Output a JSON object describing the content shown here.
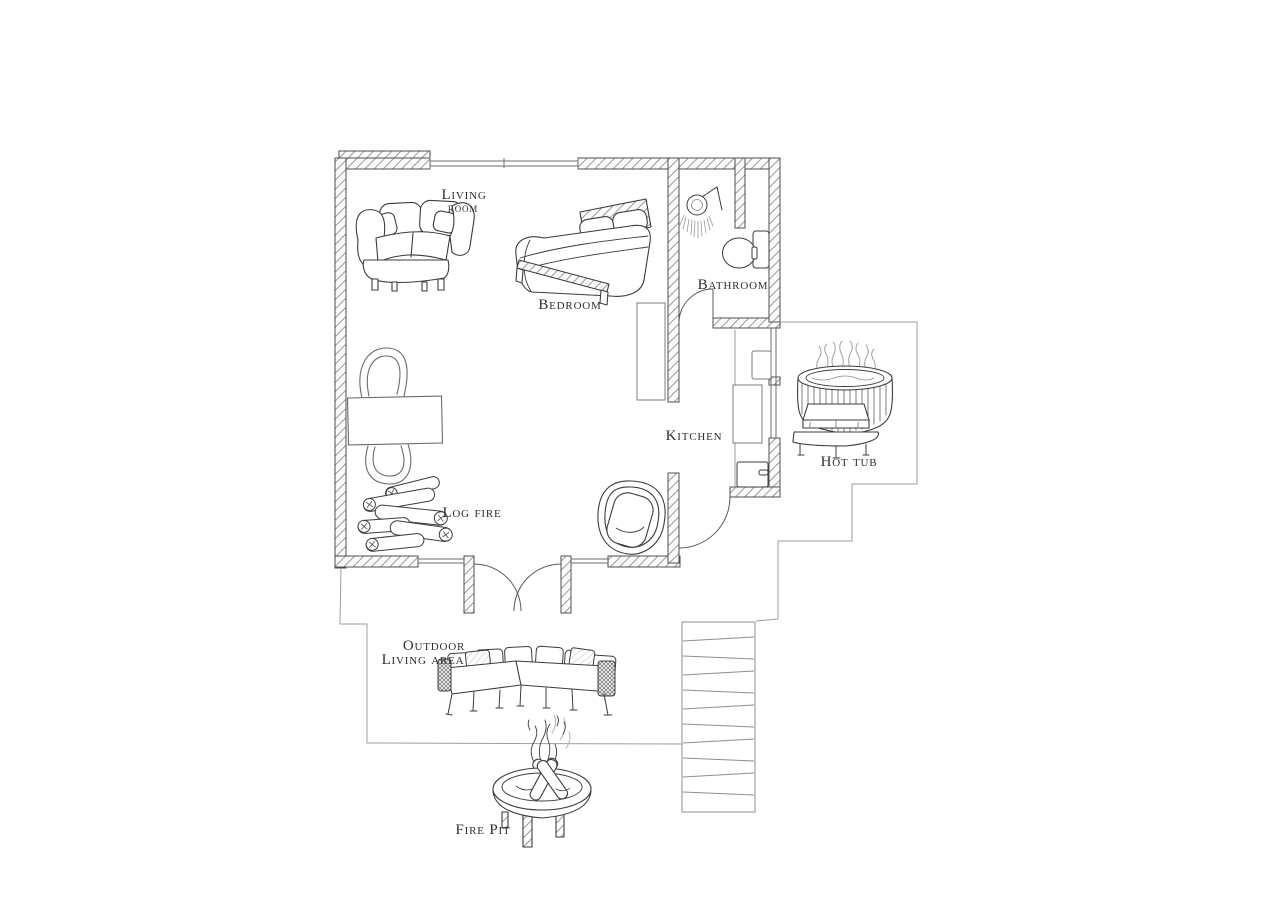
{
  "floorplan": {
    "labels": {
      "living_room_line1": "Living",
      "living_room_line2": "room",
      "bedroom": "Bedroom",
      "bathroom": "Bathroom",
      "kitchen": "Kitchen",
      "hot_tub": "Hot tub",
      "log_fire": "Log fire",
      "outdoor_living_line1": "Outdoor",
      "outdoor_living_line2": "Living area",
      "fire_pit": "Fire Pit"
    },
    "colors": {
      "background": "#ffffff",
      "ink": "#3c3c3c",
      "wall_hatch": "#8a8a8a",
      "boundary_line": "#9e9e9e"
    }
  }
}
